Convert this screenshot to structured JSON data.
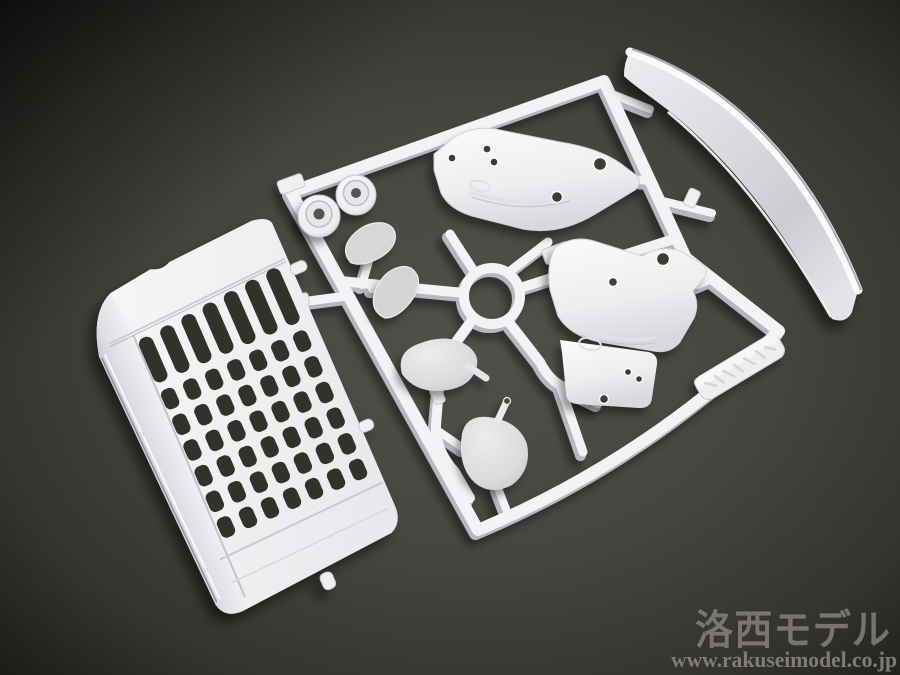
{
  "scene": {
    "subject": "white-plastic-model-kit-sprue-photo",
    "background_center_color": "#4f4e48",
    "background_edge_color": "#151513",
    "plastic_color": "#f3f3f5",
    "plastic_shade_color": "#c3c5ca",
    "slot_dark_color": "#28271f"
  },
  "watermark": {
    "logo": "洛西モデル",
    "url": "www.rakuseimodel.co.jp",
    "text_color": "#87857d",
    "outline_color": "#2e2d29"
  },
  "parts": {
    "frame": "sprue-runner-frame",
    "ring": "sprue-center-ring",
    "grille": "front-grille-panel",
    "blade": "roof-deflector-blade",
    "deflector_upper": "corner-deflector-part-upper",
    "deflector_lower": "corner-deflector-part-lower",
    "mirror_faces": "mirror-face-pair",
    "mirror_housings": "mirror-housing-pair",
    "caps": "round-cap-pair",
    "tag": "molded-brand-tag"
  }
}
